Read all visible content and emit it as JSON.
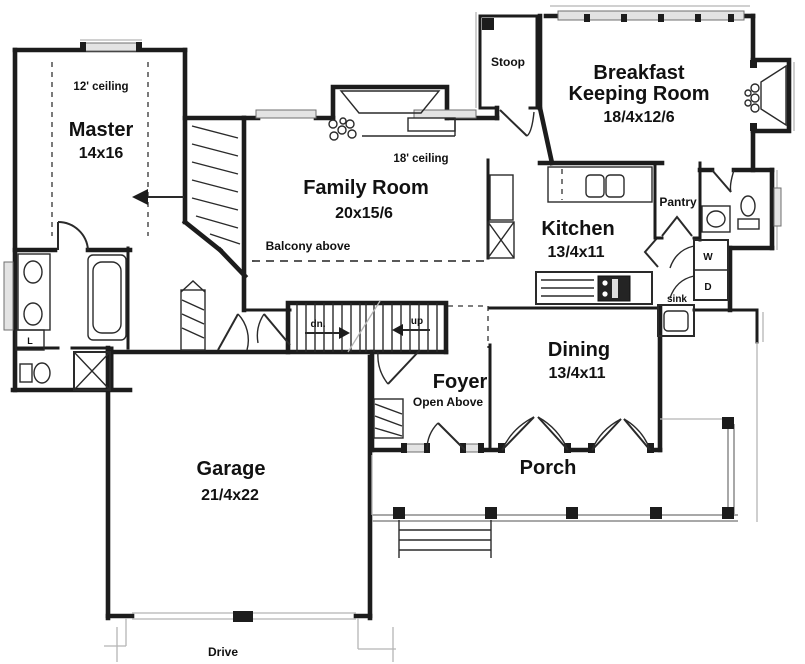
{
  "meta": {
    "type": "first-floor-plan",
    "background": "#ffffff",
    "wall_color": "#1c1c1c",
    "light_line_color": "#a8a8a8"
  },
  "rooms": {
    "master": {
      "ceiling": "12' ceiling",
      "name": "Master",
      "dims": "14x16"
    },
    "family": {
      "ceiling": "18' ceiling",
      "name": "Family Room",
      "dims": "20x15/6"
    },
    "breakfast": {
      "name_line1": "Breakfast",
      "name_line2": "Keeping Room",
      "dims": "18/4x12/6"
    },
    "kitchen": {
      "name": "Kitchen",
      "dims": "13/4x11"
    },
    "dining": {
      "name": "Dining",
      "dims": "13/4x11"
    },
    "foyer": {
      "name": "Foyer",
      "note": "Open Above"
    },
    "garage": {
      "name": "Garage",
      "dims": "21/4x22"
    },
    "porch": {
      "name": "Porch"
    },
    "stoop": {
      "name": "Stoop"
    },
    "pantry": {
      "name": "Pantry"
    }
  },
  "annotations": {
    "balcony_above": "Balcony above",
    "stairs_down": "dn.",
    "stairs_up": "up",
    "washer": "W",
    "dryer": "D",
    "sink": "sink",
    "linen": "L",
    "drive": "Drive"
  }
}
